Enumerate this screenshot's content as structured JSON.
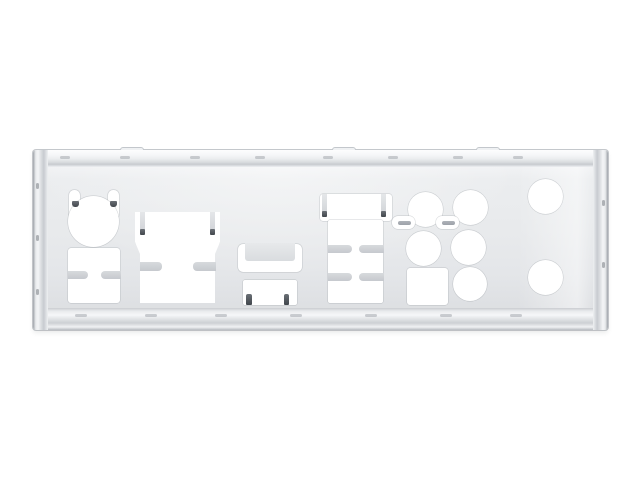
{
  "scene": {
    "type": "product-photo",
    "description": "Silver stainless-steel motherboard rear I/O shield plate with stamped port cutouts (PS/2, USB, VGA, video, audio jacks, S/PDIF and round holes) photographed on a plain white background",
    "background_color": "#ffffff"
  },
  "plate": {
    "x": 33,
    "y": 150,
    "width": 575,
    "height": 180,
    "colors": {
      "face": "#e8eaec",
      "rim_highlight": "#f6f7f9",
      "rim_shadow": "#c7cacf",
      "edge_dark": "#9ea3a9",
      "emi_notch_gray": "#cbced3",
      "emi_tab_gray": "#d7dadd",
      "finger_gray": "#a6abb1",
      "dark_mark": "#4a4f55",
      "cutout_white": "#ffffff"
    },
    "top_ticks_x": [
      60,
      120,
      190,
      255,
      323,
      388,
      453,
      513
    ],
    "bottom_ticks_x": [
      75,
      145,
      215,
      290,
      365,
      440,
      510
    ],
    "left_ticks_y": [
      183,
      235,
      289
    ],
    "right_ticks_y": [
      200,
      262
    ],
    "bump_tabs_x": [
      120,
      332,
      476
    ]
  },
  "cutouts": [
    {
      "name": "ps2-tab-left-cutout",
      "shape": "rect",
      "x": 69,
      "y": 190,
      "w": 11,
      "h": 28,
      "r": "5px 5px 3px 3px"
    },
    {
      "name": "ps2-tab-right-cutout",
      "shape": "rect",
      "x": 108,
      "y": 190,
      "w": 11,
      "h": 28,
      "r": "5px 5px 3px 3px"
    },
    {
      "name": "ps2-port-cutout",
      "shape": "circle",
      "cx": 93.5,
      "cy": 221.5,
      "r": 25.5
    },
    {
      "name": "usb-pair-cutout",
      "shape": "rect",
      "x": 68,
      "y": 248,
      "w": 52,
      "h": 55,
      "r": "3px"
    },
    {
      "name": "vga-port-cutout",
      "shape": "polygon",
      "x": 135,
      "y": 212,
      "w": 85,
      "h": 91,
      "points": [
        [
          0,
          0
        ],
        [
          85,
          0
        ],
        [
          85,
          30
        ],
        [
          80,
          42
        ],
        [
          80,
          91
        ],
        [
          5,
          91
        ],
        [
          5,
          42
        ],
        [
          0,
          30
        ]
      ]
    },
    {
      "name": "displayport-bracket-cutout",
      "shape": "rect",
      "x": 238,
      "y": 244,
      "w": 64,
      "h": 28,
      "r": "5px"
    },
    {
      "name": "hdmi-port-cutout",
      "shape": "rect",
      "x": 243,
      "y": 280,
      "w": 54,
      "h": 25,
      "r": "2px"
    },
    {
      "name": "usb-stack-top-cutout",
      "shape": "rect",
      "x": 320,
      "y": 194,
      "w": 72,
      "h": 27,
      "r": "3px"
    },
    {
      "name": "usb-stack-body-cutout",
      "shape": "rect",
      "x": 328,
      "y": 220,
      "w": 55,
      "h": 83,
      "r": "2px"
    },
    {
      "name": "audio-jack-cutout-1",
      "shape": "circle",
      "cx": 425.5,
      "cy": 209,
      "r": 17.5
    },
    {
      "name": "audio-jack-cutout-2",
      "shape": "circle",
      "cx": 470,
      "cy": 207.5,
      "r": 17.5
    },
    {
      "name": "audio-jack-cutout-3",
      "shape": "circle",
      "cx": 423.5,
      "cy": 248,
      "r": 17.5
    },
    {
      "name": "audio-jack-cutout-4",
      "shape": "circle",
      "cx": 468.5,
      "cy": 247,
      "r": 17.5
    },
    {
      "name": "audio-jack-cutout-5",
      "shape": "circle",
      "cx": 470,
      "cy": 283.5,
      "r": 17
    },
    {
      "name": "vent-slot-cutout-1",
      "shape": "rect",
      "x": 392,
      "y": 216,
      "w": 23,
      "h": 12.5,
      "r": "6px"
    },
    {
      "name": "vent-slot-cutout-2",
      "shape": "rect",
      "x": 436,
      "y": 216,
      "w": 23,
      "h": 12.5,
      "r": "6px"
    },
    {
      "name": "spdif-port-cutout",
      "shape": "rect",
      "x": 407,
      "y": 268,
      "w": 41,
      "h": 37,
      "r": "3px"
    },
    {
      "name": "round-cutout-upper-right",
      "shape": "circle",
      "cx": 545,
      "cy": 196,
      "r": 17.5
    },
    {
      "name": "round-cutout-lower-right",
      "shape": "circle",
      "cx": 545,
      "cy": 277.5,
      "r": 17.5
    }
  ],
  "overlays": [
    {
      "name": "emi-notch-usbpair-left",
      "variant": "notch",
      "x": 67.5,
      "y": 271,
      "w": 20,
      "h": 8,
      "r": "0 4px 4px 0"
    },
    {
      "name": "emi-notch-usbpair-right",
      "variant": "notch",
      "x": 100.5,
      "y": 271,
      "w": 20,
      "h": 8,
      "r": "4px 0 0 4px"
    },
    {
      "name": "emi-tab-vga-left",
      "variant": "tab",
      "x": 139.5,
      "y": 212,
      "w": 5,
      "h": 21,
      "r": "0 0 2px 2px"
    },
    {
      "name": "emi-tab-vga-right",
      "variant": "tab",
      "x": 210,
      "y": 212,
      "w": 5,
      "h": 21,
      "r": "0 0 2px 2px"
    },
    {
      "name": "emi-notch-vga-left",
      "variant": "notch",
      "x": 139.5,
      "y": 262,
      "w": 22,
      "h": 9,
      "r": "0 4px 4px 0"
    },
    {
      "name": "emi-notch-vga-right",
      "variant": "notch",
      "x": 193,
      "y": 262,
      "w": 22.5,
      "h": 9,
      "r": "4px 0 0 4px"
    },
    {
      "name": "bracket-interior",
      "variant": "face",
      "x": 245,
      "y": 243,
      "w": 50,
      "h": 18,
      "r": "0 0 3px 3px"
    },
    {
      "name": "emi-tab-usbstack-left",
      "variant": "tab",
      "x": 322,
      "y": 194,
      "w": 5,
      "h": 22,
      "r": "0 0 2px 2px"
    },
    {
      "name": "emi-tab-usbstack-right",
      "variant": "tab",
      "x": 380.5,
      "y": 194,
      "w": 5,
      "h": 22,
      "r": "0 0 2px 2px"
    },
    {
      "name": "emi-notch-usbstack-r1-left",
      "variant": "notch",
      "x": 327.5,
      "y": 244.5,
      "w": 24,
      "h": 8,
      "r": "0 4px 4px 0"
    },
    {
      "name": "emi-notch-usbstack-r1-right",
      "variant": "notch",
      "x": 359,
      "y": 244.5,
      "w": 24.5,
      "h": 8,
      "r": "4px 0 0 4px"
    },
    {
      "name": "emi-notch-usbstack-r2-left",
      "variant": "notch",
      "x": 327.5,
      "y": 273,
      "w": 24,
      "h": 8,
      "r": "0 4px 4px 0"
    },
    {
      "name": "emi-notch-usbstack-r2-right",
      "variant": "notch",
      "x": 359,
      "y": 273,
      "w": 24.5,
      "h": 8,
      "r": "4px 0 0 4px"
    },
    {
      "name": "vent-finger-1",
      "variant": "finger",
      "x": 397.5,
      "y": 220.5,
      "w": 13,
      "h": 4.5,
      "r": "2.5px"
    },
    {
      "name": "vent-finger-2",
      "variant": "finger",
      "x": 441.5,
      "y": 220.5,
      "w": 13,
      "h": 4.5,
      "r": "2.5px"
    }
  ],
  "dark_marks": [
    {
      "name": "ps2-latch-mark-left",
      "x": 71.5,
      "y": 200.5,
      "w": 7,
      "h": 6.5,
      "r": "1px 1px 3px 3px"
    },
    {
      "name": "ps2-latch-mark-right",
      "x": 109.5,
      "y": 200.5,
      "w": 7,
      "h": 6.5,
      "r": "1px 1px 3px 3px"
    },
    {
      "name": "vga-tab-tip-left",
      "x": 139.5,
      "y": 228.5,
      "w": 5,
      "h": 6,
      "r": "1px"
    },
    {
      "name": "vga-tab-tip-right",
      "x": 210,
      "y": 228.5,
      "w": 5,
      "h": 6,
      "r": "1px"
    },
    {
      "name": "usbstack-tab-tip-left",
      "x": 322,
      "y": 210.5,
      "w": 5,
      "h": 6,
      "r": "1px"
    },
    {
      "name": "usbstack-tab-tip-right",
      "x": 380.5,
      "y": 210.5,
      "w": 5,
      "h": 6,
      "r": "1px"
    },
    {
      "name": "hdmi-latch-mark-left",
      "x": 246,
      "y": 293.5,
      "w": 5.5,
      "h": 11.5,
      "r": "2px 2px 1px 1px"
    },
    {
      "name": "hdmi-latch-mark-right",
      "x": 283.5,
      "y": 293.5,
      "w": 5.5,
      "h": 11.5,
      "r": "2px 2px 1px 1px"
    }
  ]
}
